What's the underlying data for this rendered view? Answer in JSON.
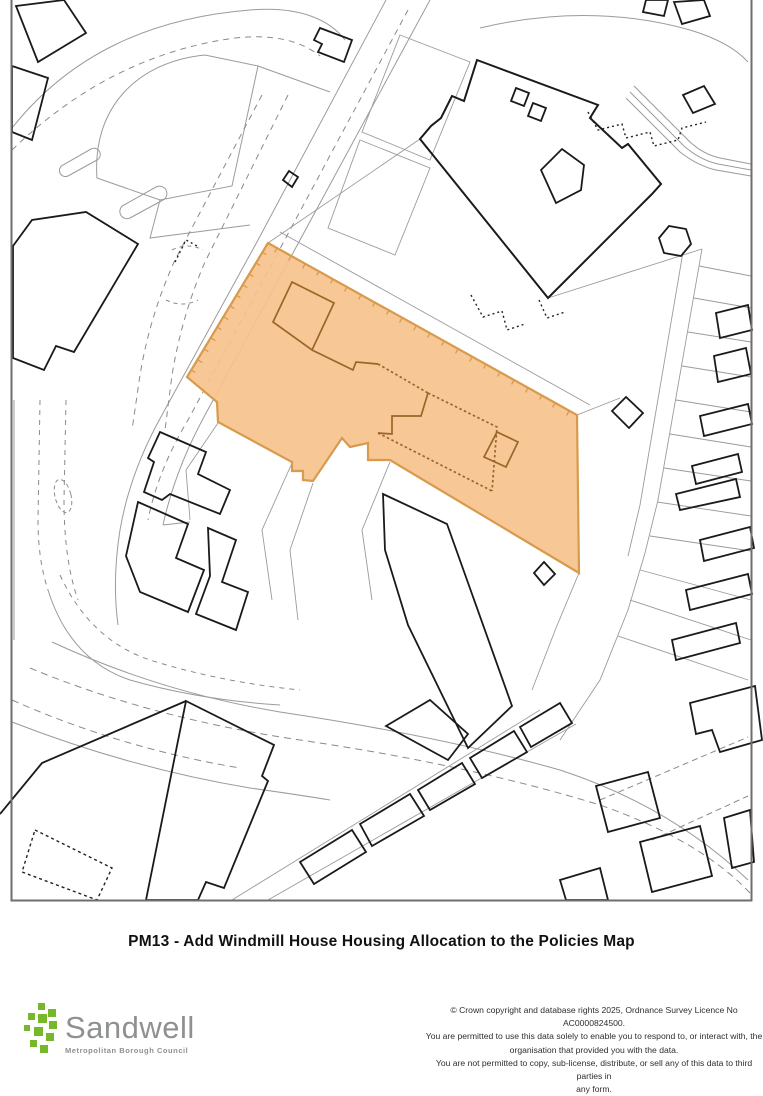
{
  "title": {
    "text": "PM13 - Add Windmill House Housing Allocation to the Policies Map"
  },
  "map": {
    "description": "Ordnance Survey style extract with highlighted housing allocation site",
    "allocation": {
      "label": "Windmill House Housing Allocation",
      "fill": "#F6C28D",
      "stroke": "#D89A4C",
      "building_stroke": "#9A6527"
    },
    "border_color": "#6e6e6e",
    "building_color": "#1a1a1a",
    "parcel_color": "#9b9b9b",
    "dash_color": "#8a8a8a"
  },
  "footer": {
    "logo": {
      "name": "Sandwell",
      "subtitle": "Metropolitan Borough Council",
      "square_color": "#76B82A",
      "text_color": "#8E9092"
    },
    "copyright_lines": [
      "© Crown copyright and database rights 2025, Ordnance Survey Licence No AC0000824500.",
      "You are permitted to use this data solely to enable you to respond to, or interact with, the",
      "organisation that provided you with the data.",
      "You are not permitted to copy, sub-license, distribute, or sell any of this data to third parties in",
      "any form."
    ]
  }
}
